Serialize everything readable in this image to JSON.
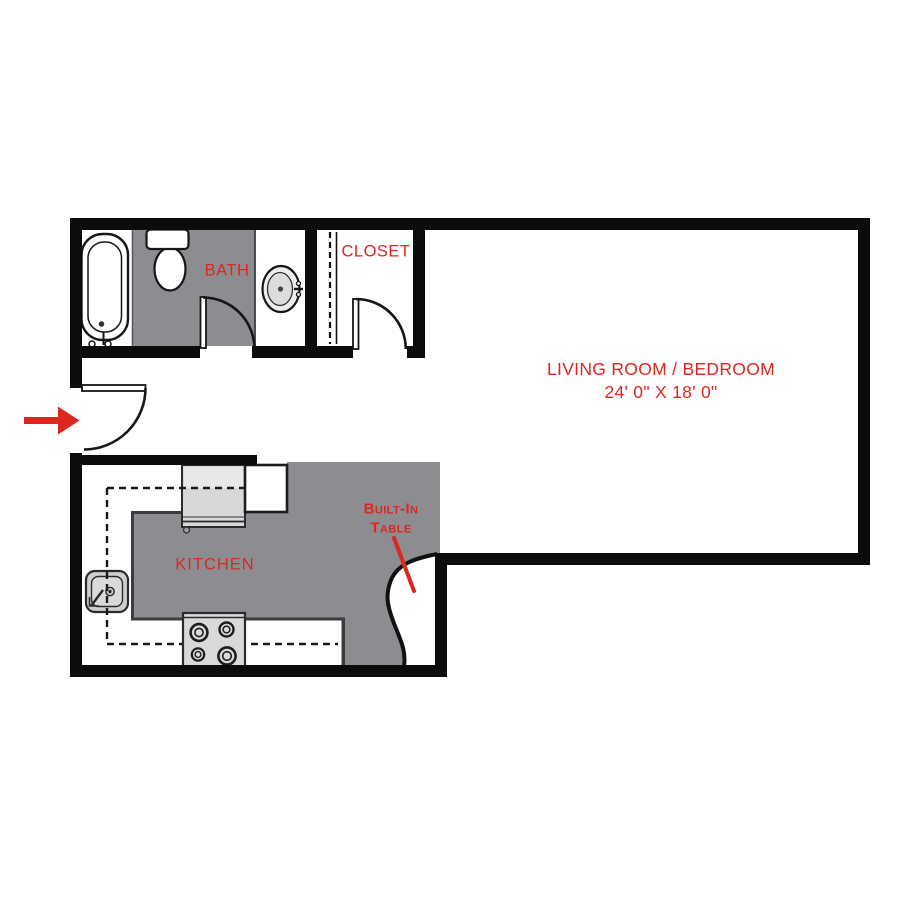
{
  "rooms": {
    "bath": {
      "label": "BATH"
    },
    "closet": {
      "label": "CLOSET"
    },
    "living_room": {
      "label": "LIVING ROOM / BEDROOM",
      "dimensions": "24' 0\" X 18' 0\""
    },
    "kitchen": {
      "label": "KITCHEN"
    },
    "built_in_table": {
      "line1": "Built-In",
      "line2": "Table"
    }
  },
  "icons": {
    "entry-arrow-icon": "red right-pointing arrow at entry door",
    "bathtub-icon": "oval tub with faucet",
    "toilet-icon": "tank and bowl",
    "vanity-sink-icon": "oval basin with faucet",
    "closet-rod-icon": "dashed rod line with shelf line",
    "refrigerator-icon": "gray appliance box",
    "cabinet-icon": "white counter box",
    "kitchen-sink-icon": "square basin with faucet",
    "stove-icon": "four burner cooktop",
    "door-swing-icon": "quarter-circle door arc"
  },
  "colors": {
    "wall_black": "#0c0c0c",
    "floor_gray": "#8d8d91",
    "appliance_gray": "#d8d8da",
    "label_red": "#dc2721"
  }
}
